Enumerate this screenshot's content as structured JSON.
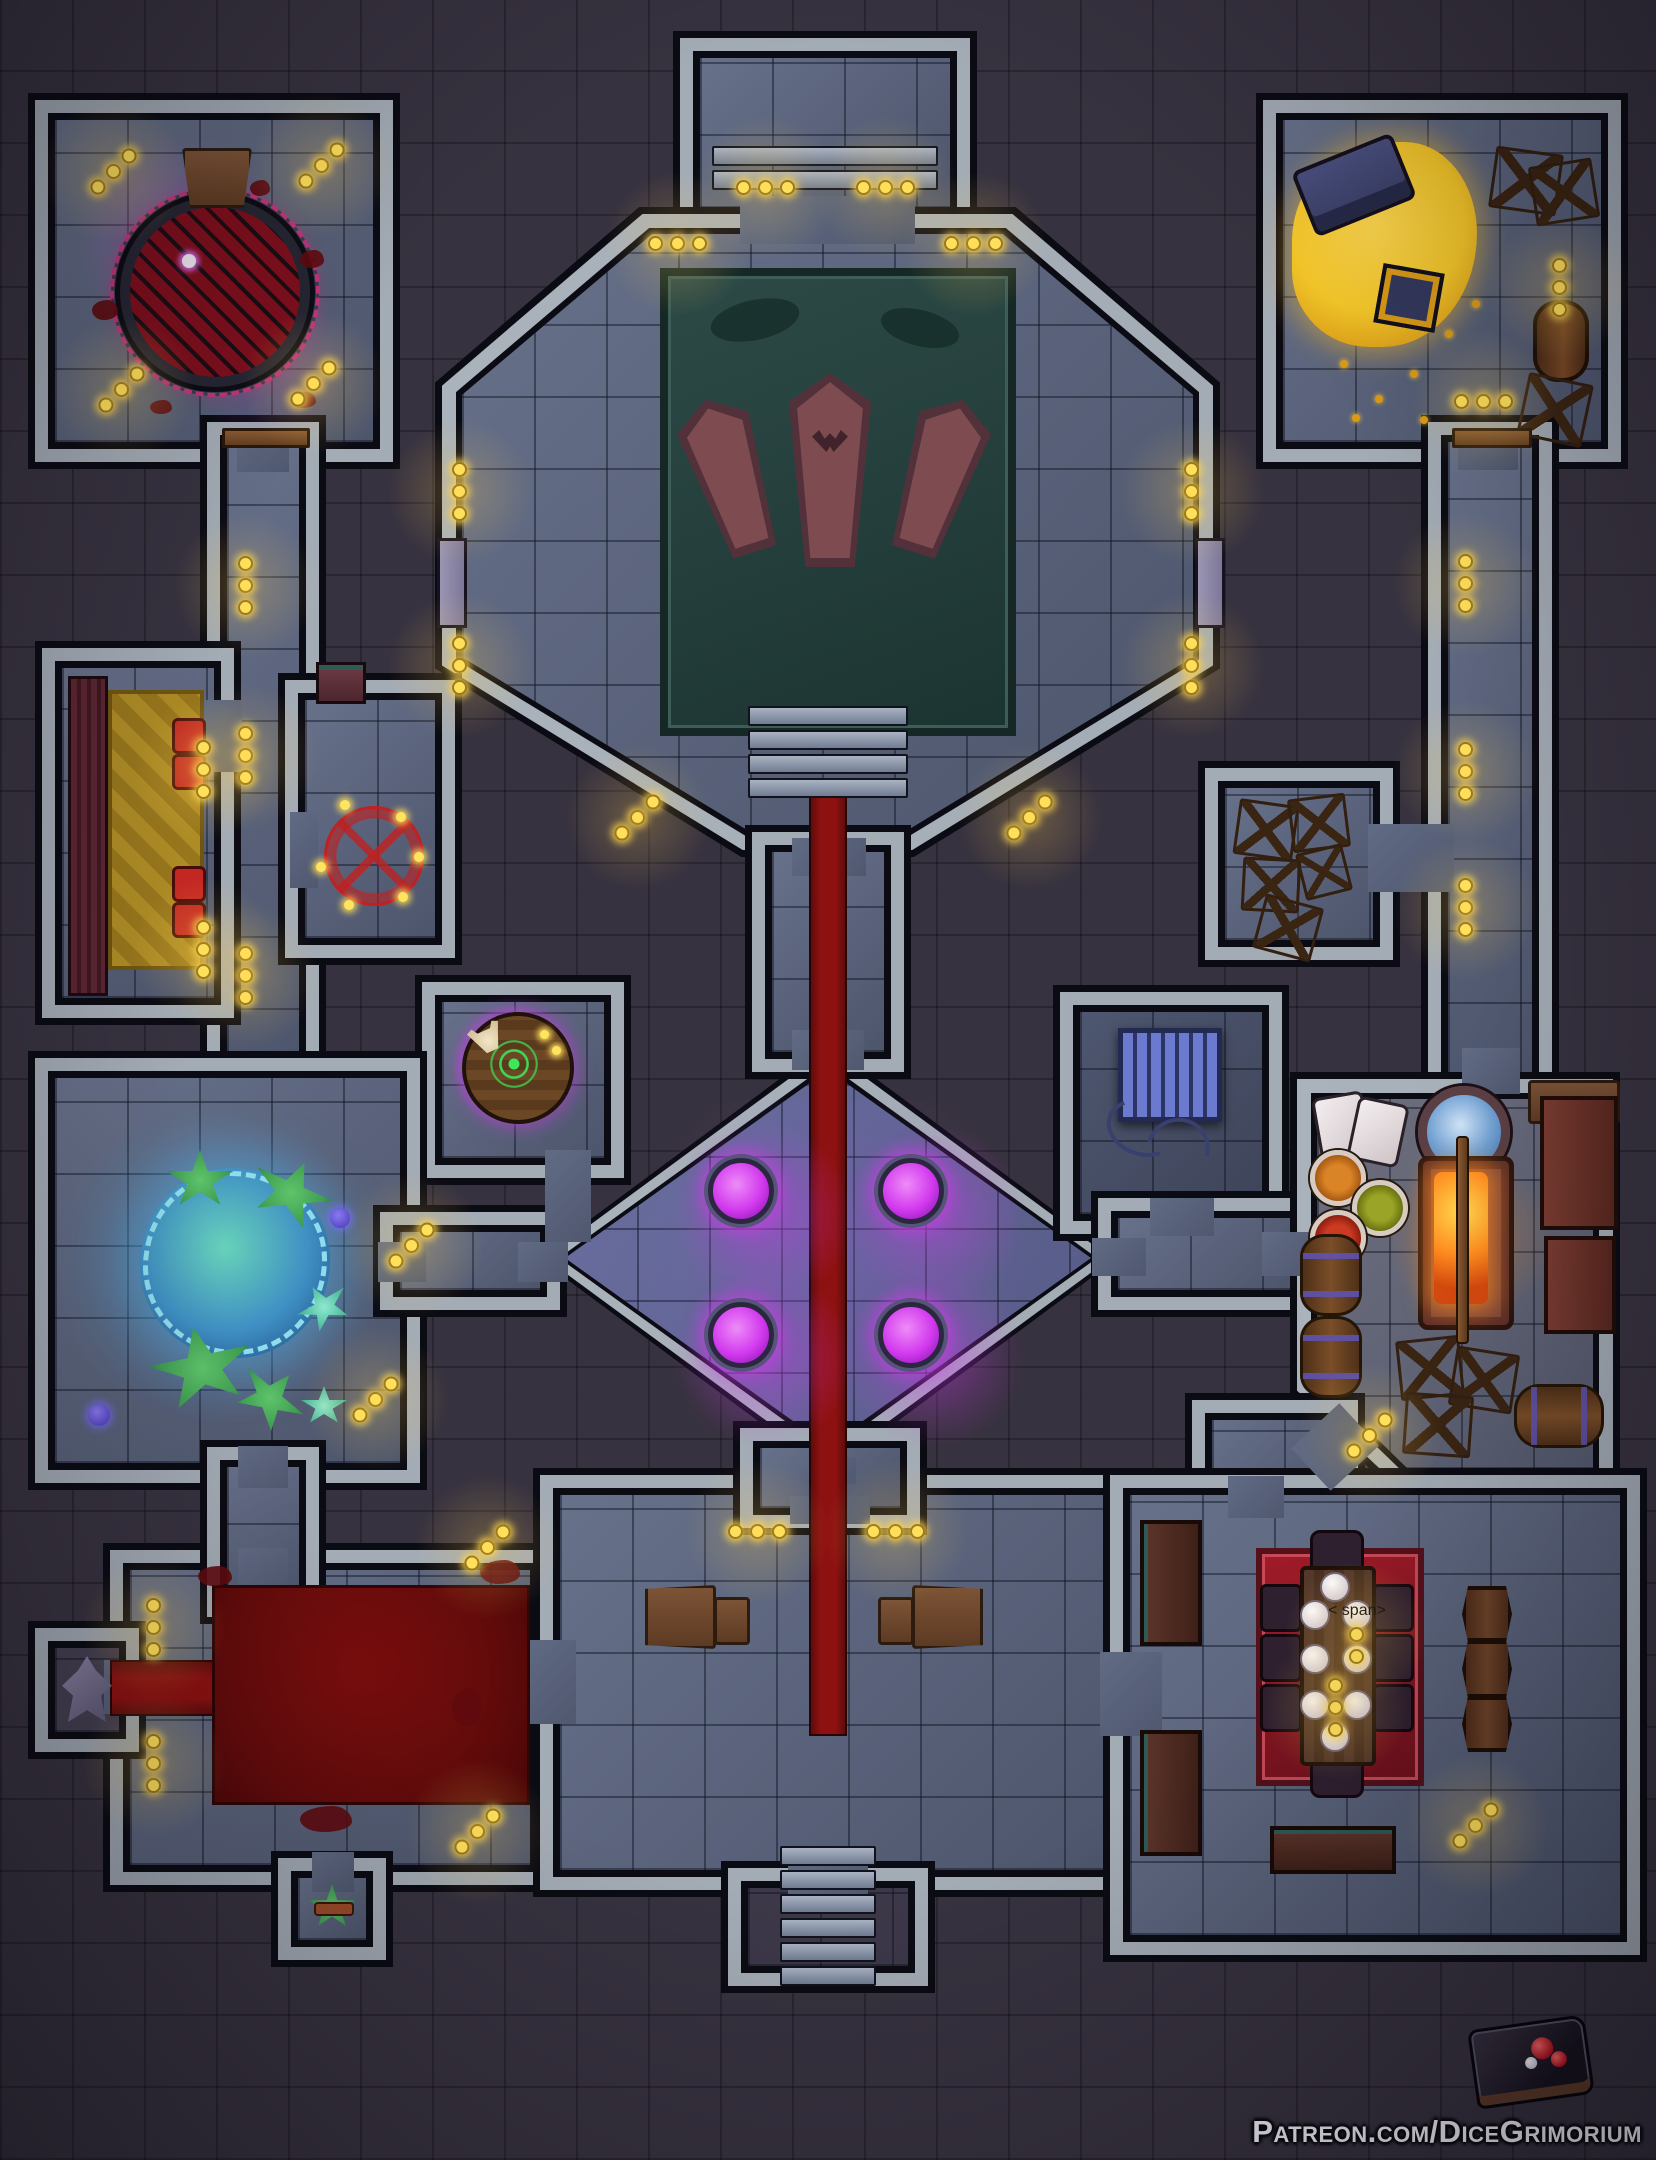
{
  "watermark": {
    "text": "Patreon.com/DiceGrimorium",
    "logo_icon": "grimoire-book-with-red-dice-icon"
  },
  "palette": {
    "bg": "#37323f",
    "floor_hi": "#67718a",
    "floor_lo": "#4d556c",
    "wall_stone": "#a3abb5",
    "wall_ink": "#0b0b13",
    "rug_teal": "#2d4a47",
    "rug_teal_dark": "#1c3431",
    "coffin_frame": "#53313a",
    "coffin_body": "#7d4b50",
    "carpet_red": "#8e1111",
    "carpet_red_deep": "#5e0c0c",
    "blood": "#5f0a0e",
    "blood_pool": "#650b0b",
    "dining_rug": "#a01b28",
    "dining_rug_deep": "#6e111c",
    "wood": "#7c5336",
    "counter_red": "#6e3b34",
    "gold": "#f6c829",
    "gold_deep": "#db9b16",
    "candle": "#ffe45e",
    "purple_glow": "#b14fd4",
    "brazier": "#d239ee",
    "blue_glow": "#4fb3e8",
    "plant": "#3f9e52",
    "teal_plant": "#67d2b9",
    "fire": "#ff8c1f",
    "fire_hi": "#ffd84e",
    "cage": "#6b7ace",
    "ritual_green": "#3ae858",
    "penta_red": "#c02020",
    "curtain": "#5c2633",
    "chapel_gold": "#ad8b25",
    "vat_red": "#aa1520",
    "plate": "#d9d2e2",
    "purple_band": "#5e54b8",
    "navy_chest": "#3a3f66",
    "statue": "#8d86a8"
  },
  "features": {
    "rooms": [
      "blood-vat-chamber",
      "vampire-crypt",
      "treasure-room",
      "chapel",
      "pentagram-room",
      "ritual-table-room",
      "glowing-garden",
      "brazier-hall",
      "cage-cell",
      "kitchen-forge",
      "crate-storage",
      "blood-pool-chamber",
      "great-hall",
      "dining-room"
    ],
    "coffins": 3,
    "arcane_braziers": 4,
    "dining_plates": 8,
    "dining_chairs": 8,
    "objects": [
      "blood-vat-grate",
      "gold-pile",
      "overturned-chest",
      "wooden-crates",
      "gold-carpet",
      "red-cushions",
      "summoning-circle",
      "bull-skull-table",
      "glowing-bush",
      "metal-cage-with-chains",
      "fire-pit-with-spit",
      "water-basin",
      "food-bowls",
      "supply-barrels",
      "gargoyle-statue",
      "potted-plant",
      "stairs-down",
      "red-carpet",
      "candle-sconces"
    ]
  }
}
